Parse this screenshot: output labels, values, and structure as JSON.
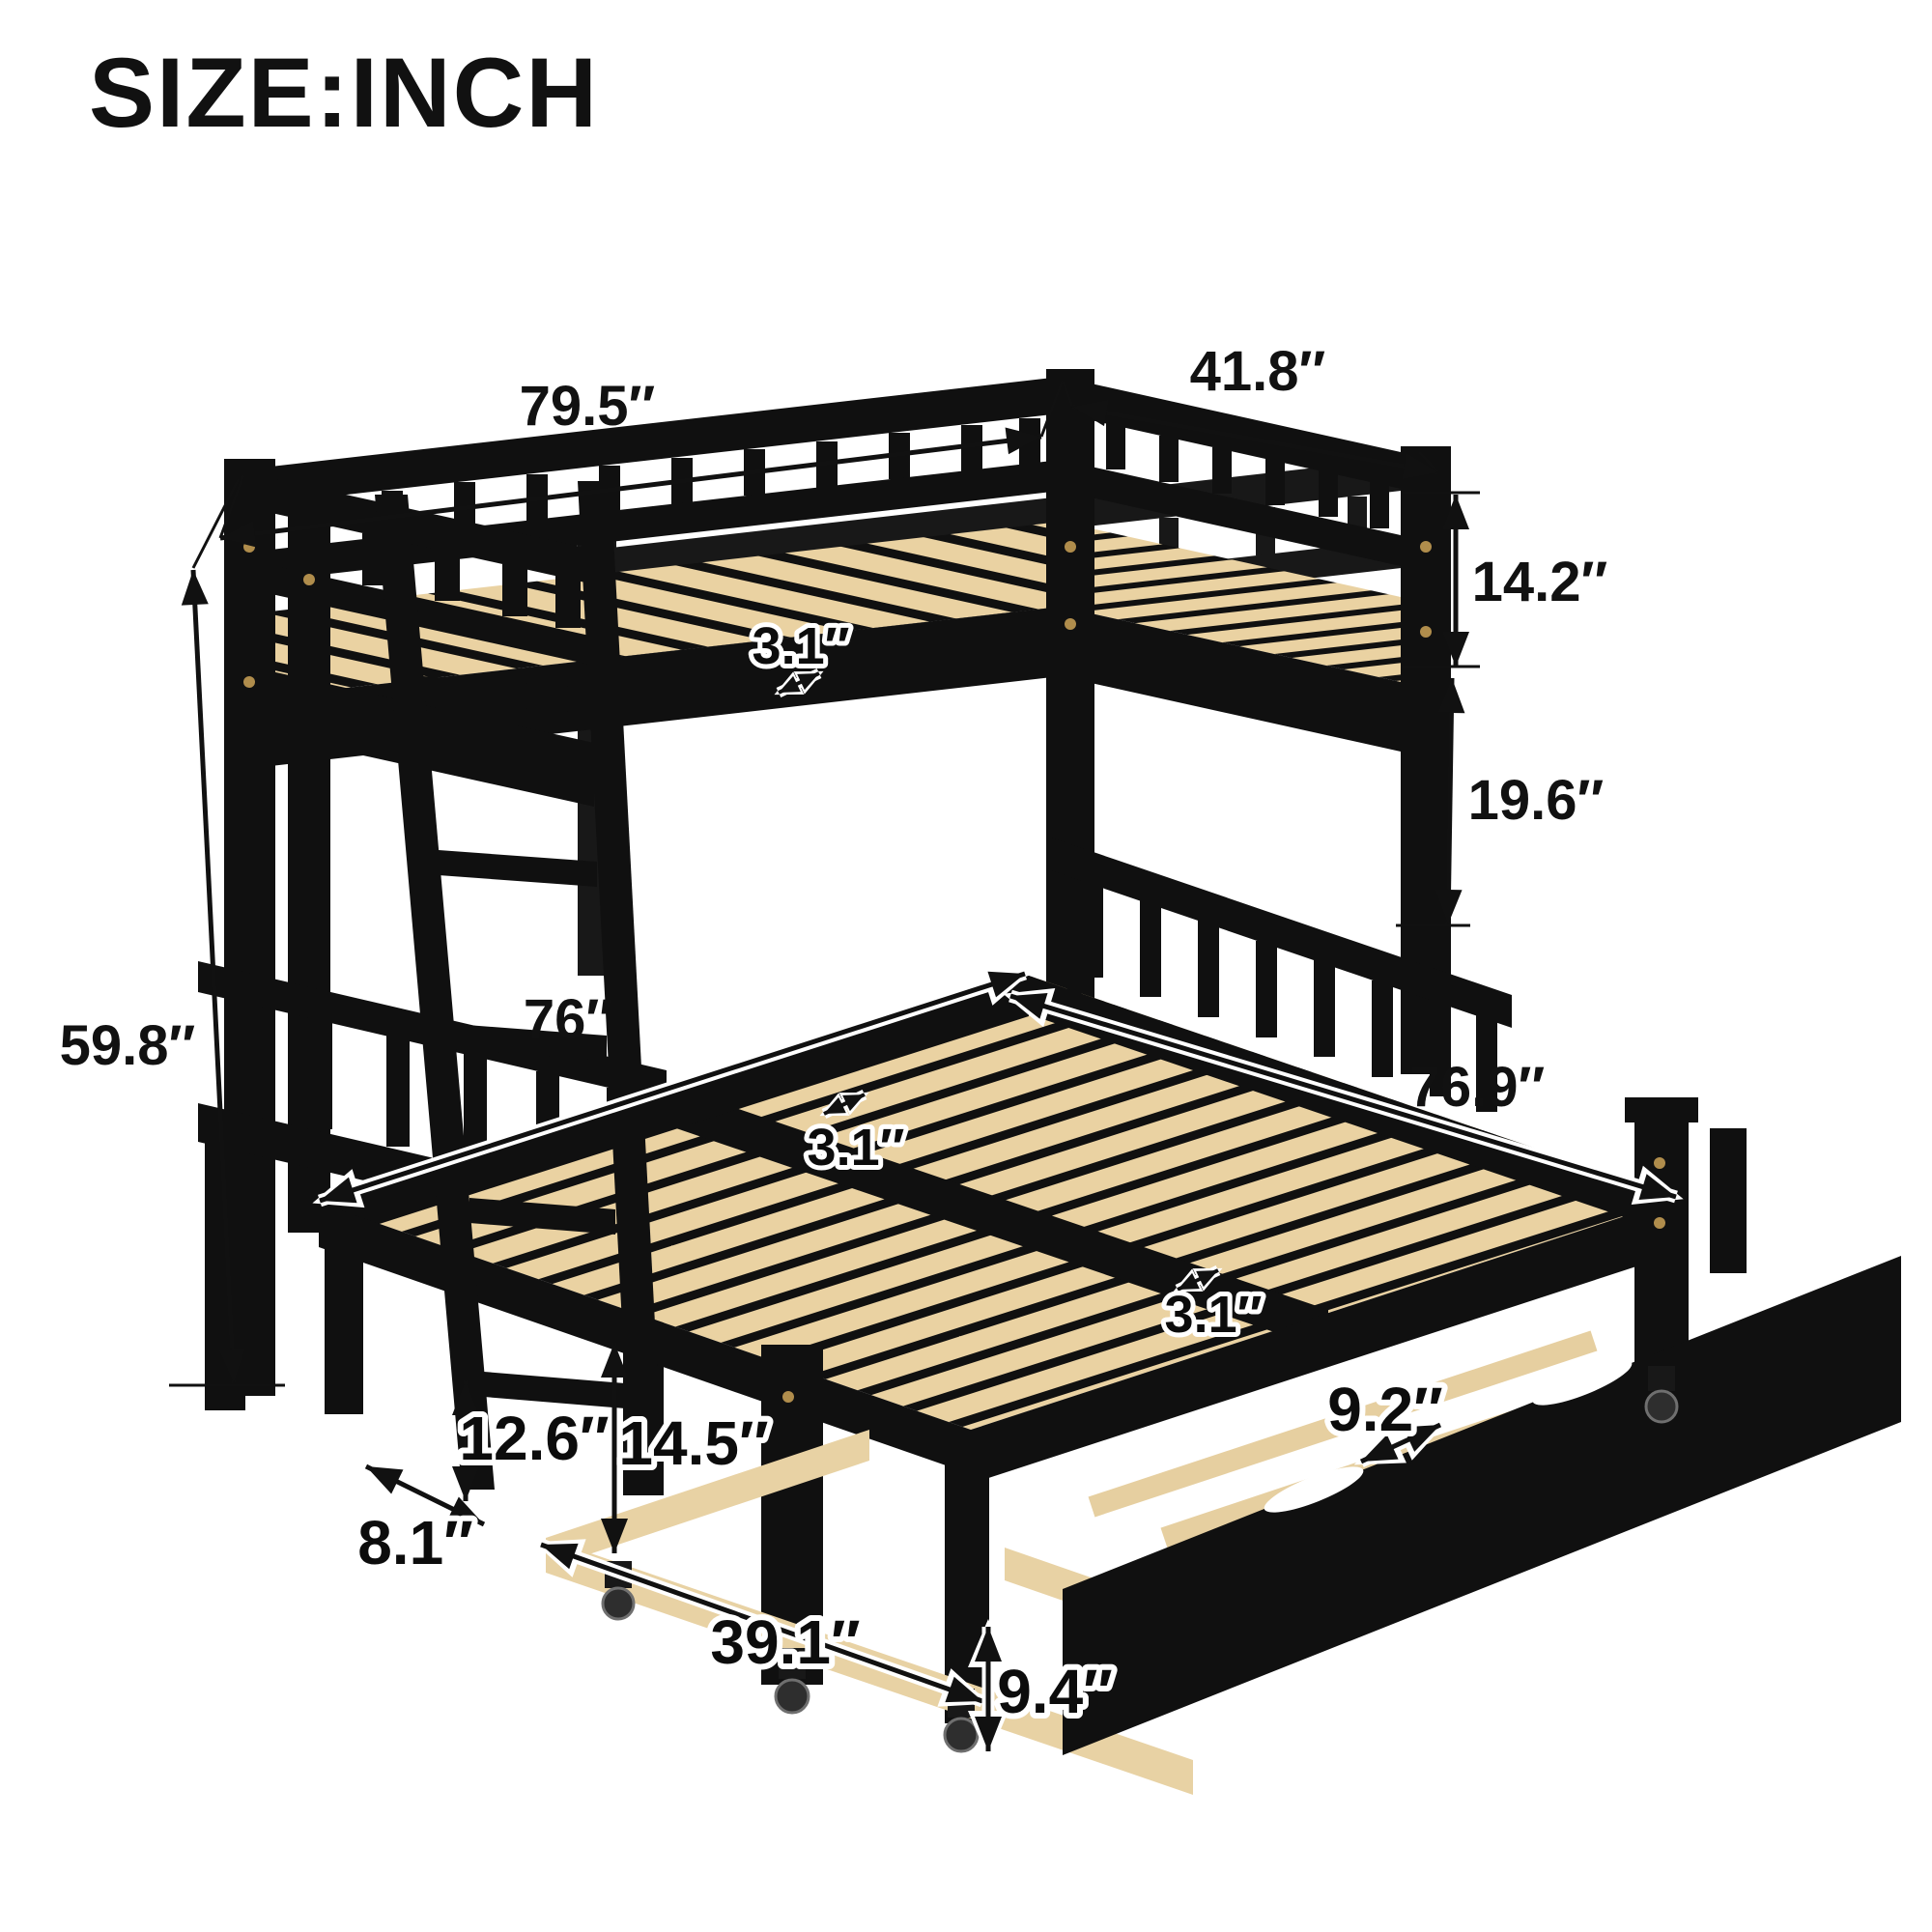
{
  "title": "SIZE:INCH",
  "figure": "twin bunk bed over pull-out bed with trundle, black wood frame with natural wood slats",
  "unit": "inch",
  "colors": {
    "background": "#ffffff",
    "frame_black": "#101010",
    "slat_wood": "#ead2a2",
    "wood_edge": "#c9a96e",
    "hardware_gold": "#b08d4c",
    "dimension_ink": "#111111"
  },
  "dims": {
    "bunk_length": "79.5″",
    "bunk_width": "41.8″",
    "guardrail_height": "14.2″",
    "bunk_gap_height": "19.6″",
    "overall_height": "59.8″",
    "upper_slat_spacing": "3.1″",
    "pullout_bed_length": "76″",
    "pullout_bed_width": "76.9″",
    "pullout_slat_spacing": "3.1″",
    "pullout_slat_spacing_2": "3.1″",
    "front_leg_height": "12.6″",
    "ladder_foot_depth": "8.1″",
    "under_bed_clearance": "14.5″",
    "trundle_width": "39.1″",
    "trundle_slat_spacing": "9.2″",
    "trundle_height": "9.4″"
  }
}
